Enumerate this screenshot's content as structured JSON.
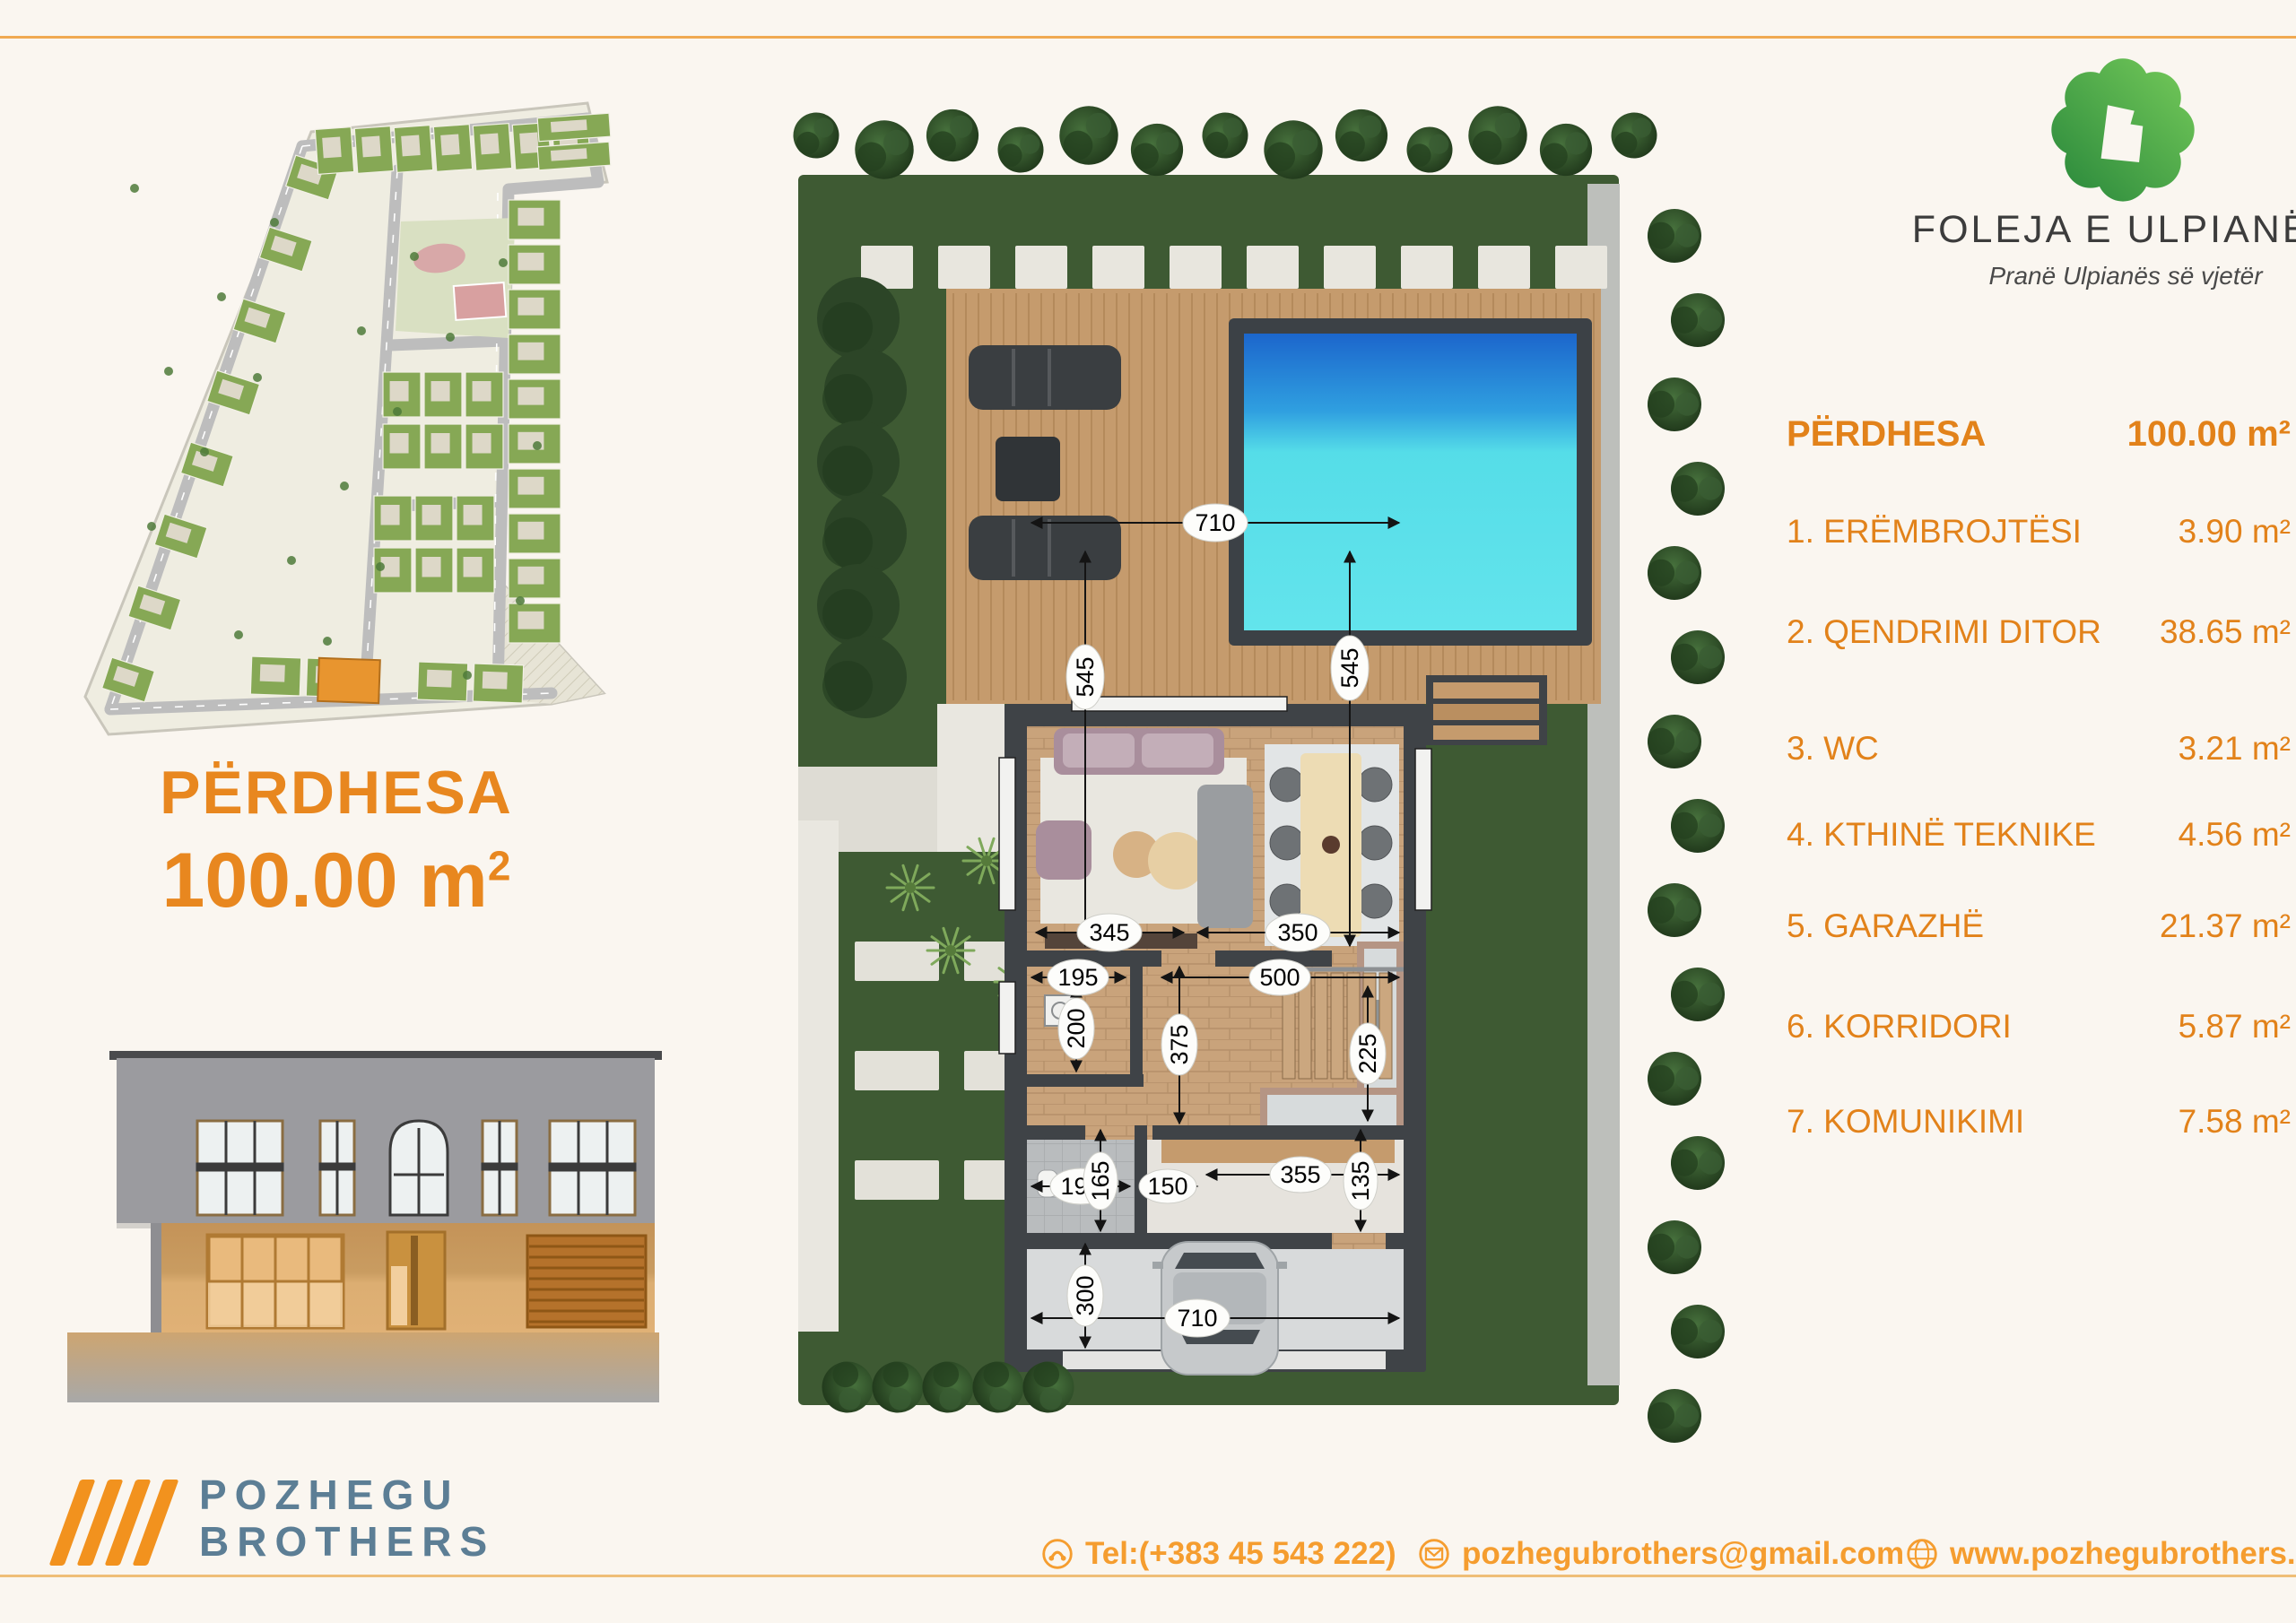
{
  "project": {
    "name": "FOLEJA E ULPIANËS",
    "tagline": "Pranë Ulpianës së vjetër",
    "logo_green_dark": "#2E8C3D",
    "logo_green_light": "#6EC457"
  },
  "title_block": {
    "floor_label": "PËRDHESA",
    "area_text": "100.00 m",
    "area_exp": "2"
  },
  "legend": {
    "header_label": "PËRDHESA",
    "header_area": "100.00 m²",
    "rooms": [
      {
        "label": "1. ERËMBROJTËSI",
        "area": "3.90 m²"
      },
      {
        "label": "2. QENDRIMI DITOR",
        "area": "38.65 m²"
      },
      {
        "label": "3. WC",
        "area": "3.21 m²"
      },
      {
        "label": "4. KTHINË TEKNIKE",
        "area": "4.56 m²"
      },
      {
        "label": "5. GARAZHË",
        "area": "21.37 m²"
      },
      {
        "label": "6. KORRIDORI",
        "area": "5.87 m²"
      },
      {
        "label": "7. KOMUNIKIMI",
        "area": "7.58 m²"
      }
    ],
    "text_color": "#E2821A"
  },
  "company": {
    "name_top": "POZHEGU",
    "name_bottom": "BROTHERS",
    "slash_color": "#F2921E",
    "text_color": "#5C7E95"
  },
  "contacts": {
    "phone": "Tel:(+383 45 543 222)",
    "email": "pozhegubrothers@gmail.com",
    "website": "www.pozhegubrothers.com",
    "color": "#F59D2F"
  },
  "floor_plan": {
    "dims": {
      "top_width": "710",
      "living_height_left": "545",
      "living_height_right": "545",
      "tv_wall": "345",
      "kitchen_width": "350",
      "hall_small": "195",
      "hall_width": "500",
      "tech_height": "200",
      "stairs_height": "225",
      "corridor_height": "375",
      "wc_width": "195",
      "wc_height": "165",
      "door_width": "150",
      "komunikimi_width": "355",
      "komunikimi_height": "135",
      "garage_depth": "300",
      "garage_width": "710"
    }
  }
}
